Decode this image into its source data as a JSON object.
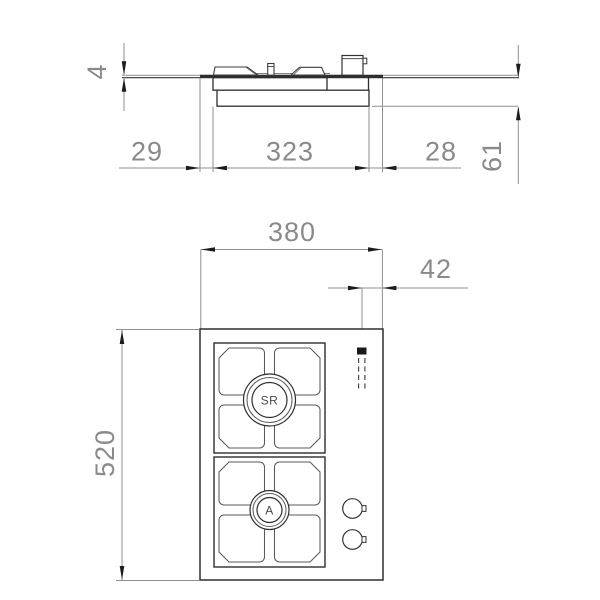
{
  "side_view": {
    "labels": {
      "top_thickness": "4",
      "left_clearance": "29",
      "cutout_width": "323",
      "right_clearance": "28",
      "depth_below_top": "61"
    }
  },
  "plan_view": {
    "labels": {
      "overall_width": "380",
      "gas_inlet_offset": "42",
      "overall_depth": "520"
    },
    "burners": [
      {
        "label": "SR"
      },
      {
        "label": "A"
      }
    ]
  },
  "colors": {
    "object_line": "#2e2e2e",
    "dimension_line": "#8f8f8f",
    "dimension_text": "#8a8a8a",
    "gas_marker_fill": "#191919",
    "background": "#ffffff"
  }
}
